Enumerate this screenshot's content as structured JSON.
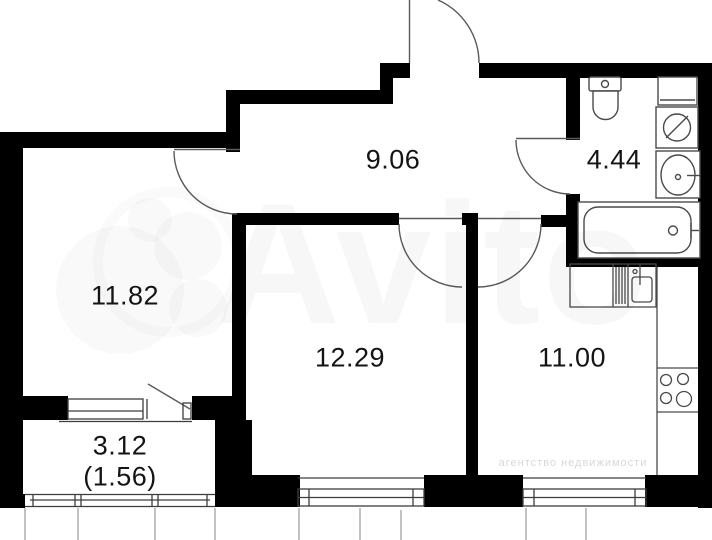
{
  "image_type": "apartment floor plan",
  "rooms": {
    "hallway_area": "9.06",
    "bathroom_area": "4.44",
    "living_room_area": "11.82",
    "bedroom_area": "12.29",
    "kitchen_area": "11.00",
    "balcony_area": "3.12",
    "balcony_area_reduced": "(1.56)"
  },
  "watermark": {
    "brand": "Avito",
    "agency_line": "агентство недвижимости"
  },
  "fixtures": {
    "bathroom": [
      "toilet",
      "shelf",
      "washing-machine",
      "sink",
      "bathtub"
    ],
    "kitchen": [
      "counter",
      "dish-rack",
      "kitchen-sink",
      "stove"
    ]
  },
  "colors": {
    "wall": "#000000",
    "fixture_line": "#4a4a4a",
    "thin_line": "#8a8a8a",
    "label_text": "#141414",
    "watermark_tint": "rgba(0,0,0,0.03)"
  }
}
